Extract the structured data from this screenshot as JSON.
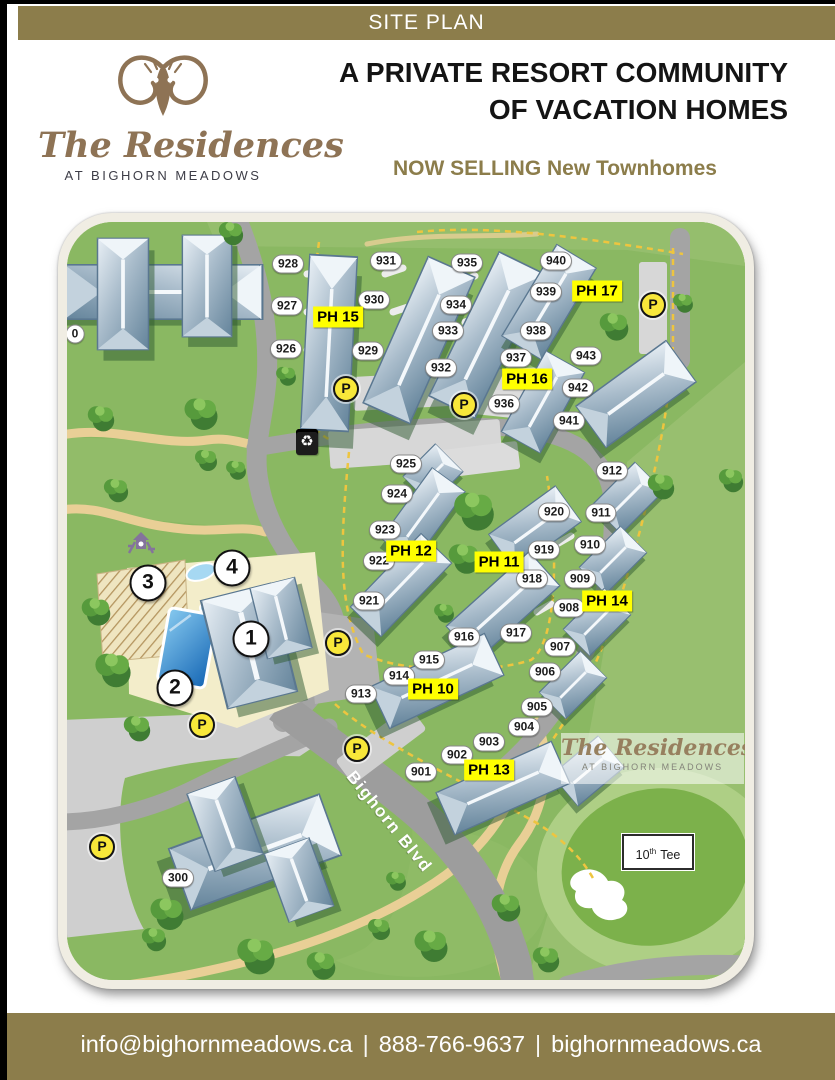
{
  "top_banner": {
    "label": "SITE PLAN"
  },
  "header": {
    "logo": {
      "script_name": "The Residences",
      "tagline": "AT BIGHORN MEADOWS"
    },
    "title_line1": "A PRIVATE RESORT COMMUNITY",
    "title_line2": "OF VACATION HOMES",
    "subtitle": "NOW SELLING New Townhomes"
  },
  "map": {
    "street_label": "Bighorn Blvd",
    "tee": {
      "number": "10",
      "ordinal": "th",
      "word": "Tee"
    },
    "watermark": {
      "script_name": "The Residences",
      "tagline": "AT BIGHORN MEADOWS"
    },
    "parking_symbol": "P",
    "unit_labels": [
      {
        "label": "0",
        "x": 8,
        "y": 112
      },
      {
        "label": "928",
        "x": 221,
        "y": 42
      },
      {
        "label": "927",
        "x": 220,
        "y": 84
      },
      {
        "label": "926",
        "x": 219,
        "y": 127
      },
      {
        "label": "931",
        "x": 319,
        "y": 39
      },
      {
        "label": "930",
        "x": 307,
        "y": 78
      },
      {
        "label": "929",
        "x": 301,
        "y": 129
      },
      {
        "label": "935",
        "x": 400,
        "y": 41
      },
      {
        "label": "934",
        "x": 389,
        "y": 83
      },
      {
        "label": "933",
        "x": 381,
        "y": 109
      },
      {
        "label": "932",
        "x": 374,
        "y": 146
      },
      {
        "label": "940",
        "x": 489,
        "y": 39
      },
      {
        "label": "939",
        "x": 479,
        "y": 70
      },
      {
        "label": "938",
        "x": 469,
        "y": 109
      },
      {
        "label": "943",
        "x": 519,
        "y": 134
      },
      {
        "label": "942",
        "x": 511,
        "y": 166
      },
      {
        "label": "941",
        "x": 502,
        "y": 199
      },
      {
        "label": "937",
        "x": 449,
        "y": 136
      },
      {
        "label": "936",
        "x": 437,
        "y": 182
      },
      {
        "label": "925",
        "x": 339,
        "y": 242
      },
      {
        "label": "924",
        "x": 330,
        "y": 272
      },
      {
        "label": "923",
        "x": 318,
        "y": 308
      },
      {
        "label": "922",
        "x": 312,
        "y": 339
      },
      {
        "label": "921",
        "x": 302,
        "y": 379
      },
      {
        "label": "920",
        "x": 487,
        "y": 290
      },
      {
        "label": "919",
        "x": 477,
        "y": 328
      },
      {
        "label": "918",
        "x": 465,
        "y": 357
      },
      {
        "label": "917",
        "x": 449,
        "y": 411
      },
      {
        "label": "912",
        "x": 545,
        "y": 249
      },
      {
        "label": "911",
        "x": 534,
        "y": 291
      },
      {
        "label": "910",
        "x": 523,
        "y": 323
      },
      {
        "label": "909",
        "x": 513,
        "y": 357
      },
      {
        "label": "908",
        "x": 502,
        "y": 386
      },
      {
        "label": "907",
        "x": 493,
        "y": 425
      },
      {
        "label": "906",
        "x": 478,
        "y": 450
      },
      {
        "label": "905",
        "x": 470,
        "y": 485
      },
      {
        "label": "904",
        "x": 457,
        "y": 505
      },
      {
        "label": "916",
        "x": 397,
        "y": 415
      },
      {
        "label": "915",
        "x": 362,
        "y": 438
      },
      {
        "label": "914",
        "x": 332,
        "y": 454
      },
      {
        "label": "913",
        "x": 294,
        "y": 472
      },
      {
        "label": "903",
        "x": 422,
        "y": 520
      },
      {
        "label": "902",
        "x": 390,
        "y": 533
      },
      {
        "label": "901",
        "x": 354,
        "y": 550
      },
      {
        "label": "300",
        "x": 111,
        "y": 656
      }
    ],
    "ph_labels": [
      {
        "label": "PH 15",
        "x": 271,
        "y": 95
      },
      {
        "label": "PH 16",
        "x": 460,
        "y": 157
      },
      {
        "label": "PH 17",
        "x": 530,
        "y": 69
      },
      {
        "label": "PH 12",
        "x": 344,
        "y": 329
      },
      {
        "label": "PH 11",
        "x": 432,
        "y": 340
      },
      {
        "label": "PH 14",
        "x": 540,
        "y": 379
      },
      {
        "label": "PH 10",
        "x": 366,
        "y": 467
      },
      {
        "label": "PH 13",
        "x": 422,
        "y": 548
      }
    ],
    "parking_markers": [
      {
        "x": 279,
        "y": 167
      },
      {
        "x": 586,
        "y": 83
      },
      {
        "x": 397,
        "y": 183
      },
      {
        "x": 271,
        "y": 421
      },
      {
        "x": 290,
        "y": 527
      },
      {
        "x": 135,
        "y": 503
      },
      {
        "x": 35,
        "y": 625
      }
    ],
    "amenity_markers": [
      {
        "label": "1",
        "x": 184,
        "y": 417
      },
      {
        "label": "2",
        "x": 108,
        "y": 466
      },
      {
        "label": "3",
        "x": 81,
        "y": 361
      },
      {
        "label": "4",
        "x": 165,
        "y": 346
      }
    ],
    "icons": [
      {
        "name": "recycling-bin",
        "x": 240,
        "y": 220
      },
      {
        "name": "playground",
        "x": 74,
        "y": 323
      }
    ]
  },
  "footer": {
    "email": "info@bighornmeadows.ca",
    "phone": "888-766-9637",
    "website": "bighornmeadows.ca",
    "separator": "|"
  },
  "colors": {
    "accent_olive": "#8c7d4b",
    "ph_highlight": "#ffff00",
    "parking_yellow": "#f8e73a",
    "map_green": "#8ab862"
  }
}
